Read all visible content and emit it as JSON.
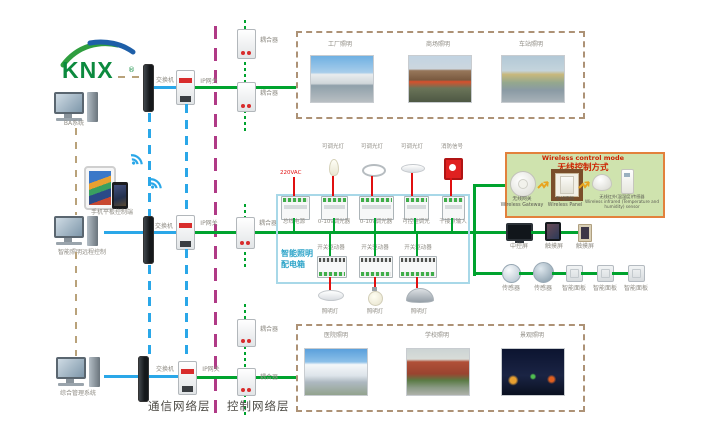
{
  "logo": {
    "text": "KNX"
  },
  "endpoints": {
    "ba": "BA系统",
    "mobile": "手机平板控制端",
    "remote": "智能照明远程控制",
    "management": "综合管理系统"
  },
  "net": {
    "switch": "交换机",
    "gateway": "IP网关",
    "coupler": "耦合器"
  },
  "layers": {
    "comm": "通信网络层",
    "ctrl": "控制网络层"
  },
  "apps_top": {
    "factory": "工厂照明",
    "mall": "商场照明",
    "station": "车站照明"
  },
  "apps_bottom": {
    "hospital": "医院照明",
    "school": "学校照明",
    "landscape": "景观照明"
  },
  "dist": {
    "t1": "智能照明",
    "t2": "配电箱",
    "mains": "220VAC",
    "dim_lamp": "可调光灯",
    "fire": "消防信号",
    "bus_power": "总线电源",
    "dimmer": "0-10v调光器",
    "scr": "可控硅调光",
    "dry": "干接点输入",
    "actuator": "开关驱动器",
    "lamp": "照明灯"
  },
  "wireless": {
    "title_en": "Wireless control mode",
    "title_zh": "无线控制方式",
    "gw_zh": "无线网关",
    "gw_en": "Wireless Gateway",
    "panel_zh": "无线面板",
    "panel_en": "Wireless Panel",
    "sensor_zh": "无线红外(温湿度)传感器",
    "sensor_en": "Wireless infrared (Temperature and humidity) sensor"
  },
  "right": {
    "central": "中控屏",
    "touch": "触摸屏",
    "sensor": "传感器",
    "panel": "智能面板"
  },
  "colors": {
    "bus_green": "#00a32e",
    "lan_blue": "#2aa7e8",
    "power_red": "#e01010",
    "backbone_tan": "#b9a27a",
    "divider_magenta": "#b03a86",
    "distbox_border": "#a8d8e8",
    "wireless_bg": "#cfe3ae",
    "wireless_border": "#e2813c",
    "knx_green": "#0c8a3e",
    "knx_blue": "#1e5fa8"
  }
}
